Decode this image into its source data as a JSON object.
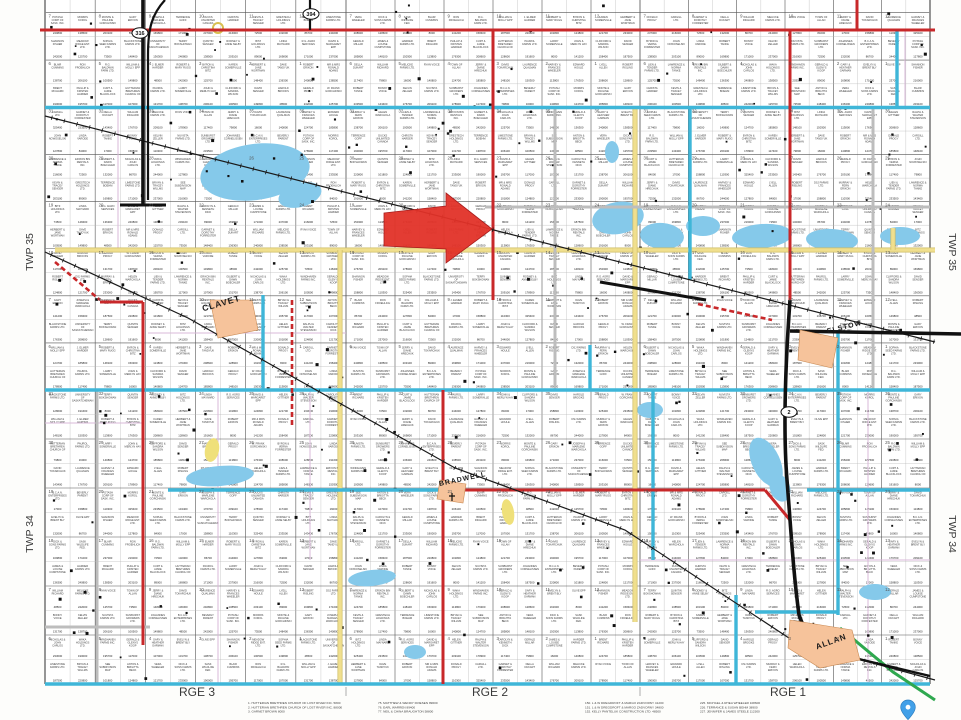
{
  "map": {
    "title": "Rural municipality land ownership plat map",
    "township_left": [
      "TWP 35",
      "TWP 34"
    ],
    "township_right": [
      "TWP 35",
      "TWP 34"
    ],
    "range_labels": [
      "RGE 3",
      "RGE 2",
      "RGE 1"
    ],
    "towns": [
      {
        "name": "CLAVET"
      },
      {
        "name": "ELSTOW"
      },
      {
        "name": "BRADWELL"
      },
      {
        "name": "ALLAN"
      }
    ],
    "highway_shields": [
      "316",
      "394",
      "2"
    ],
    "section_numbering": [
      [
        31,
        32,
        33,
        34,
        35,
        36
      ],
      [
        30,
        29,
        28,
        27,
        26,
        25
      ],
      [
        19,
        20,
        21,
        22,
        23,
        24
      ],
      [
        18,
        17,
        16,
        15,
        14,
        13
      ],
      [
        7,
        8,
        9,
        10,
        11,
        12
      ],
      [
        6,
        5,
        4,
        3,
        2,
        1
      ]
    ],
    "owners": [
      "POTASH CORP OF SASK. INC.",
      "LYELL ALLEN",
      "HAROLD BROOKS",
      "MR & MRS RONALD ADAMS",
      "RALPH & WALTER STEVENSON",
      "VERA WHEELER",
      "OLIVE EPP",
      "MORRIS KOROL",
      "ROBERT RISLING",
      "GERALD PROGY",
      "DONALD PROGY",
      "CAROLYN & KENNETH DICK",
      "DICK & SONS FARMS LTD.",
      "SHANNON FISHER",
      "MONTE & PAULINE GORCHINSKI",
      "DSJ FARMS LTD.",
      "W. FRANK GORCHINSKI",
      "CARGILL LTD.",
      "GERALD MILLAR",
      "SASK WILDLIFE FED.",
      "MEADOW RIDGE ENT. LTD.",
      "GARY ERIXON",
      "MURRAY & FERN ERIXON",
      "BYRON & VERNA FORRESTER",
      "GARNET & DOROTHY FORRESTER",
      "JAMES & LOUISE CUMPSTONE",
      "BLAIR CUMMINS",
      "SOPHIA SEED FARMS LTD.",
      "JOSEPH & MARLENE WARCHOLA",
      "HELEN WARCHOLA",
      "JOHN NOWOSELSKI",
      "DELLA DUKART",
      "HARDER FARMS LTD.",
      "RON FROEHLICH",
      "BLACKSTONE FARMS LTD.",
      "TERRENCE GOFF",
      "LIEN & TENDER FARMS LTD.",
      "LINDA VARODE",
      "WILLIAM RICHARD",
      "BRENT RICHARD",
      "R.G. BALDWIN FARM LTD.",
      "UNIVERSITY OF SASKATCHEWAN",
      "DUCKS UNLIMITED CANADA",
      "LAWRENCE & NORMA TANKE",
      "ROBERT TANKE",
      "MELICKE FARMS LTD.",
      "PHILLIP & KRISTEN HARDER",
      "WILLIAM & MOLLY EPP",
      "TERRY BOKSHOWAN",
      "CHRISTA HARDER",
      "ERIXON BIN RENTALS INC.",
      "BONNY VOICE",
      "RYAN VOICE",
      "CURT & JAMIE BLACKLOCK",
      "J. ELMER HARDER",
      "QUINTIN SENGER",
      "KEVIN & TRACEY SENGER",
      "GILBERT & DAWN BOECHLER",
      "KELVIN ZELLER",
      "TOWN OF ALLAN",
      "HUTTERIAN BRETHREN CHURCH OF LOST RIVER",
      "ROBERT & MARY RUGG",
      "RODNEY & ANNE SELBY",
      "GRESTECH HOLDINGS LTD.",
      "NICHOLAS & JOHN CARLOS",
      "NUVISTA FARMS LTD.",
      "JERRY & DIANE HRECHUK",
      "PAUROL FARMS LTD.",
      "BYRON & CHRISTINA BITZ",
      "BITZ HOLDINGS LTD.",
      "TERRENCE BOEHM",
      "WAKA HOLDINGS LTD.",
      "SUNBURST GROWERS LTD.",
      "DAVID TOKARCHUK",
      "LARRY SOMERVILLE",
      "KAREN SOMERVILLE",
      "LINDA MAYNARD",
      "LIMESTONE FARMS LTD.",
      "WINDHAVEN FARMS INC.",
      "JOHANNES CORNELISSEN",
      "LAURENCE QUALMAN",
      "JOHN & MERLYN HAY",
      "HERBERT & JANE WORTMAN",
      "R.G. AGRO SERVICES",
      "BRYAN & TRACEY WILLMS",
      "GERALD & GLENYS KOOP",
      "B.C.A.N. ENTERPRISES LTD.",
      "HARVEY & FRANCES WHEELER",
      "CLIFFORD & SANDRA WILSON",
      "DAVE TANDYUK",
      "DAVID & MARGARET EPP",
      "SEE SUBDIVISION MAP",
      "GARY & HEATHER GARMAN",
      "BEVERLY PARENT",
      "EDWARD HOULE",
      "DAVID SENGER",
      "ROBERT ERIXON",
      "HELEN GITTNER",
      "ANTON & BRIGITTA BECK",
      "EVELYN & BRENT BLY"
    ],
    "parcel_values": [
      "240800",
      "244000",
      "178900",
      "208600",
      "233000",
      "242000",
      "237000",
      "325400",
      "185800",
      "187500",
      "138700",
      "138500",
      "127800",
      "117400",
      "128600",
      "190000",
      "125700",
      "216000",
      "233500",
      "148100",
      "220800",
      "206100",
      "203100",
      "84000",
      "79800",
      "191600",
      "195700",
      "73500",
      "72500",
      "143400",
      "150300",
      "101800",
      "100500",
      "89000",
      "17000",
      "16000",
      "8000",
      "117000",
      "148400",
      "132000",
      "176700",
      "113800",
      "124800",
      "149800",
      "169800",
      "158800",
      "140800",
      "141200",
      "107000",
      "136300",
      "86700",
      "209100",
      "176300",
      "121700",
      "48500",
      "171000",
      "110300",
      "124700",
      "158400",
      "131700"
    ],
    "legend_columns": [
      {
        "entries": [
          "1. HUTTERIAN BRETHREN CHURCH OF LOST RIVER INC. 5800",
          "2. HUTTERIAN BRETHREN CHURCH OF LOST RIVER INC. 88000",
          "3. GARNET BROWN 8000"
        ]
      },
      {
        "entries": [
          "75. MATTHEW & WENDY FRIESEN 89600",
          "76. EARL WARREN 89400",
          "77. NEIL & CHINA BRAUGHTON 58800"
        ]
      },
      {
        "entries": [
          "150. L & W DREGDROFT & MARGO ZADVORNY 41200",
          "151. L & W DREGDROFT & MARGO ZADVORNY 34800",
          "152. KELLY PANTELUK CONSTRUCTION LTD. 48500"
        ]
      },
      {
        "entries": [
          "225. MICHAEL & RHEA WHEELER 108600",
          "226. TERRANCE & SUSAN BEHM 38900",
          "227. JENNIFER & JAMES STEELE 112300"
        ]
      }
    ],
    "annotation_arrow": {
      "direction": "right",
      "color": "#e23128"
    },
    "colors": {
      "township_line": "#3fb6d8",
      "highway_red": "#c8282a",
      "road_yellow": "#f0df8e",
      "road_yellow_edge": "#cdbc66",
      "road_gray": "#bdbdbd",
      "road_green": "#2fa84f",
      "railway": "#1a1a1a",
      "water": "#85c9ea",
      "town_fill": "#f6c39b",
      "subdivision_pink": "#d9b8d9",
      "pin_blue": "#42a0e8"
    }
  }
}
